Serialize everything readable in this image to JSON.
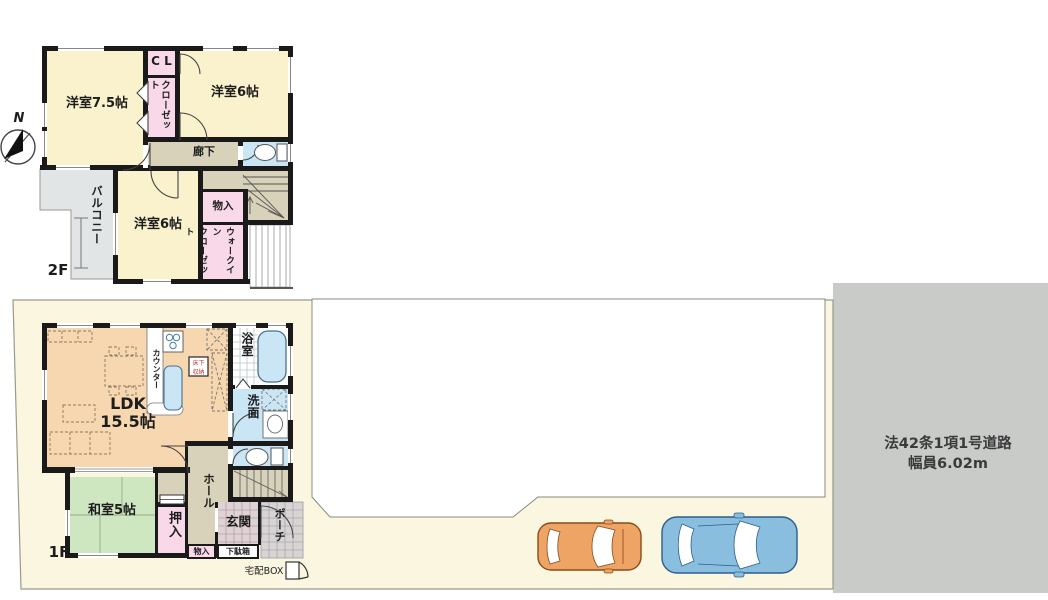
{
  "site": {
    "compass_label": "N",
    "road": {
      "line1": "法42条1項1号道路",
      "line2": "幅員6.02m"
    },
    "delivery_box_label": "宅配BOX"
  },
  "floor2": {
    "floor_label": "2F",
    "rooms": {
      "western_75": {
        "label": "洋室7.5帖"
      },
      "cl": {
        "label": "C L"
      },
      "closet": {
        "label": "クローゼット"
      },
      "western_6_upper": {
        "label": "洋室6帖"
      },
      "hallway": {
        "label": "廊下"
      },
      "storage": {
        "label": "物入"
      },
      "walk_in_closet": {
        "label": "ウォークイン\nクローゼット"
      },
      "western_6_lower": {
        "label": "洋室6帖"
      },
      "balcony": {
        "label": "バルコニー"
      }
    }
  },
  "floor1": {
    "floor_label": "1F",
    "rooms": {
      "ldk": {
        "label": "LDK\n15.5帖"
      },
      "counter": {
        "label": "カウンター"
      },
      "underfloor_storage": {
        "label": "床下\n収納"
      },
      "bathroom": {
        "label": "浴室"
      },
      "washroom": {
        "label": "洗面"
      },
      "japanese_room": {
        "label": "和室5帖"
      },
      "oshiire": {
        "label": "押入"
      },
      "hall": {
        "label": "ホール"
      },
      "storage": {
        "label": "物入"
      },
      "entrance": {
        "label": "玄関"
      },
      "shoe_cabinet": {
        "label": "下駄箱"
      },
      "porch": {
        "label": "ポーチ"
      }
    }
  },
  "icons": {
    "compass": "north-arrow-icon",
    "bathtub": "bathtub-icon",
    "toilet": "toilet-icon",
    "delivery_box": "delivery-box-icon",
    "cars": "car-top-view-icon"
  },
  "colors": {
    "room_cream": "#faf2cd",
    "ldk_peach": "#f7d7b0",
    "tatami_green": "#cfe7c0",
    "closet_pink": "#f9d9e9",
    "hall_tan": "#d7d2b9",
    "water_blue": "#cae5f4",
    "balcony_gray": "#e2e5e5",
    "lot_cream": "#fbf6df",
    "road_gray": "#c9cbc9",
    "wall": "#1a1a1a",
    "car_orange": "#eda465",
    "car_blue": "#8abede"
  }
}
